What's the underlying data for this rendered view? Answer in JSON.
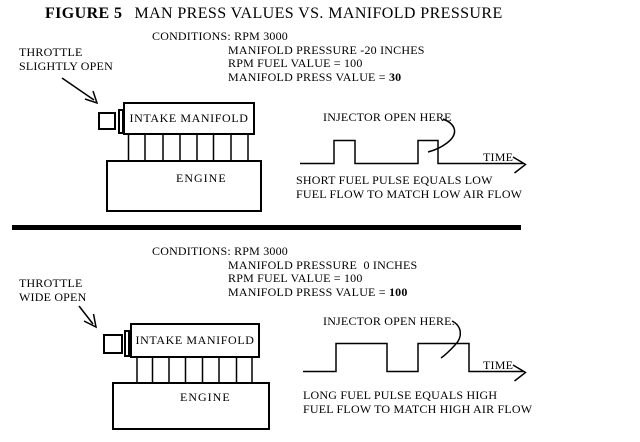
{
  "title": {
    "figure": "FIGURE 5",
    "text": "MAN PRESS VALUES VS. MANIFOLD PRESSURE"
  },
  "colors": {
    "ink": "#000000",
    "background": "#ffffff"
  },
  "sections": [
    {
      "name": "low-airflow",
      "throttle": {
        "line1": "THROTTLE",
        "line2": "SLIGHTLY OPEN"
      },
      "conditions": {
        "line1": "CONDITIONS: RPM 3000",
        "line2": "MANIFOLD PRESSURE -20 INCHES",
        "line3": "RPM FUEL VALUE = 100",
        "line4_label": "MANIFOLD PRESS VALUE = ",
        "line4_value": "30"
      },
      "diagram": {
        "intake_label": "INTAKE MANIFOLD",
        "engine_label": "ENGINE"
      },
      "waveform": {
        "injector_label": "INJECTOR OPEN HERE",
        "time_label": "TIME",
        "caption_line1": "SHORT FUEL PULSE EQUALS LOW",
        "caption_line2": "FUEL FLOW TO MATCH LOW AIR FLOW"
      }
    },
    {
      "name": "high-airflow",
      "throttle": {
        "line1": "THROTTLE",
        "line2": "WIDE OPEN"
      },
      "conditions": {
        "line1": "CONDITIONS: RPM 3000",
        "line2": "MANIFOLD PRESSURE  0 INCHES",
        "line3": "RPM FUEL VALUE = 100",
        "line4_label": "MANIFOLD PRESS VALUE = ",
        "line4_value": "100"
      },
      "diagram": {
        "intake_label": "INTAKE MANIFOLD",
        "engine_label": "ENGINE"
      },
      "waveform": {
        "injector_label": "INJECTOR OPEN HERE.",
        "time_label": "TIME",
        "caption_line1": "LONG FUEL PULSE EQUALS HIGH",
        "caption_line2": "FUEL FLOW TO MATCH HIGH AIR FLOW"
      }
    }
  ]
}
